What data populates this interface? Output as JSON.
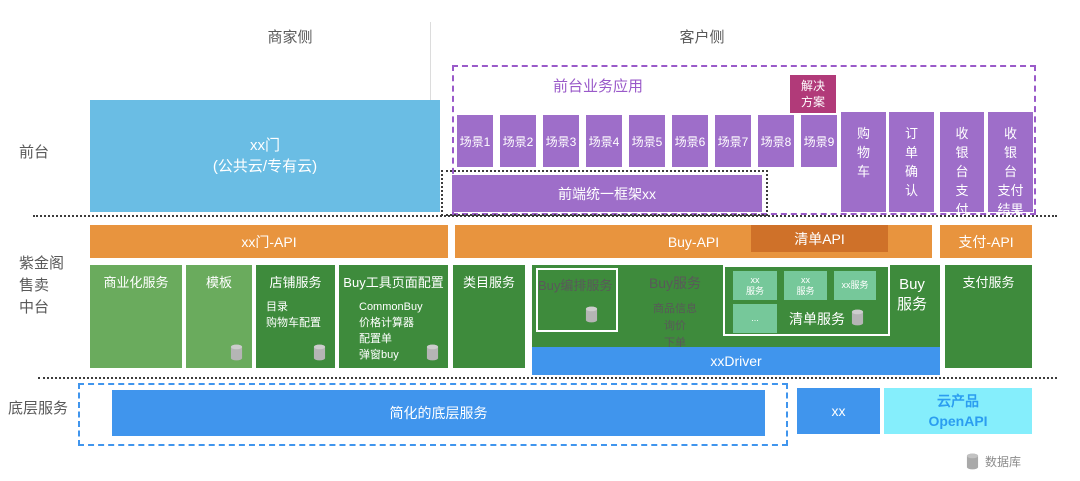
{
  "colors": {
    "purple": "#9e6ec9",
    "purple_border": "#9a5ac9",
    "magenta": "#b13a79",
    "orange": "#e8943e",
    "dark_orange": "#cf7129",
    "light_green": "#6aab5d",
    "dark_green": "#3e8b3c",
    "mint": "#76c89a",
    "sky_blue": "#6abde4",
    "blue": "#4095ed",
    "cyan": "#85eefc",
    "cyan_text": "#2b9df0"
  },
  "headers": {
    "merchant": "商家侧",
    "customer": "客户侧"
  },
  "row_labels": {
    "front": "前台",
    "middle": "紫金阁\n售卖\n中台",
    "bottom": "底层服务"
  },
  "front_stage": {
    "portal": "xx门\n(公共云/专有云)",
    "app_box": {
      "title": "前台业务应用",
      "solution": "解决\n方案",
      "scenes": [
        "场景1",
        "场景2",
        "场景3",
        "场景4",
        "场景5",
        "场景6",
        "场景7",
        "场景8",
        "场景9"
      ],
      "framework": "前端统一框架xx"
    },
    "columns": {
      "cart": "购\n物\n车",
      "order_confirm": "订\n单\n确\n认",
      "checkout_pay": "收\n银\n台\n支\n付",
      "checkout_pay_result": "收\n银\n台\n支付\n结果"
    }
  },
  "api_row": {
    "portal_api": "xx门-API",
    "buy_api": "Buy-API",
    "list_api": "清单API",
    "pay_api": "支付-API"
  },
  "services": {
    "commercial": "商业化服务",
    "template": "模板",
    "shop": {
      "title": "店铺服务",
      "items": "目录\n购物车配置"
    },
    "buy_tools": {
      "title": "Buy工具页面配置",
      "items": "CommonBuy\n价格计算器\n配置单\n弹窗buy\n..."
    },
    "category": "类目服务",
    "buy_orchestration": "Buy编排服务",
    "buy_service": {
      "title": "Buy服务",
      "items": "商品信息\n询价\n下单"
    },
    "list_service": {
      "title": "清单服务",
      "box1": "xx\n服务",
      "box2": "xx\n服务",
      "box3": "xx服务",
      "box4": "..."
    },
    "buy_right": "Buy\n服务",
    "driver": "xxDriver",
    "payment": "支付服务"
  },
  "bottom_layer": {
    "simplified": "简化的底层服务",
    "xx": "xx",
    "cloud": "云产品\nOpenAPI"
  },
  "legend": {
    "database": "数据库"
  }
}
